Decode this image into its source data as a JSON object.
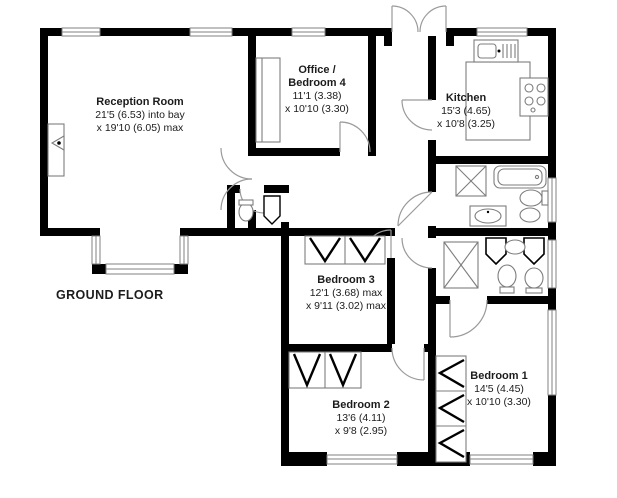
{
  "floor_label": "GROUND FLOOR",
  "colors": {
    "wall": "#000000",
    "background": "#ffffff",
    "fixture_line": "#7d7d7d",
    "door_arc": "#9a9a9a",
    "text": "#1c1c1c"
  },
  "rooms": [
    {
      "id": "reception",
      "name": "Reception Room",
      "size_line1": "21'5 (6.53) into bay",
      "size_line2": "x 19'10 (6.05) max"
    },
    {
      "id": "office",
      "name": "Office / Bedroom 4",
      "size_line1": "11'1 (3.38)",
      "size_line2": "x 10'10 (3.30)"
    },
    {
      "id": "kitchen",
      "name": "Kitchen",
      "size_line1": "15'3 (4.65)",
      "size_line2": "x 10'8 (3.25)"
    },
    {
      "id": "bedroom3",
      "name": "Bedroom 3",
      "size_line1": "12'1 (3.68) max",
      "size_line2": "x 9'11 (3.02) max"
    },
    {
      "id": "bedroom1",
      "name": "Bedroom 1",
      "size_line1": "14'5 (4.45)",
      "size_line2": "x 10'10 (3.30)"
    },
    {
      "id": "bedroom2",
      "name": "Bedroom 2",
      "size_line1": "13'6 (4.11)",
      "size_line2": "x 9'8 (2.95)"
    }
  ],
  "icons": [
    "fireplace-icon",
    "bathtub-icon",
    "shower-icon",
    "toilet-icon",
    "bidet-icon",
    "basin-icon",
    "kitchen-sink-icon",
    "hob-icon",
    "counter-icon",
    "wardrobe-icon",
    "cupboard-icon",
    "door-swing-icon",
    "window-icon",
    "entrance-double-door-icon"
  ]
}
